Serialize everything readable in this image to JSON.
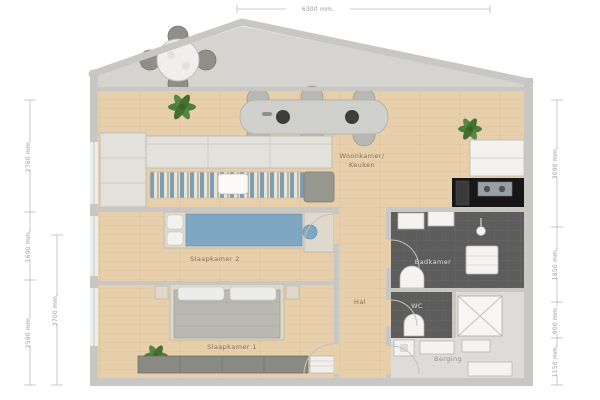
{
  "plan": {
    "type": "apartment-floor-plan",
    "rooms": {
      "living_line1": "Woonkamer/",
      "living_line2": "Keuken",
      "bedroom2": "Slaapkamer 2",
      "bedroom1": "Slaapkamer 1",
      "hall": "Hal",
      "bathroom": "Badkamer",
      "wc": "WC",
      "storage": "Berging"
    },
    "dimensions": {
      "top": "6300 mm.",
      "left_outer": [
        "2760 mm.",
        "1690 mm.",
        "2590 mm."
      ],
      "left_inner": "3700 mm.",
      "right": [
        "3090 mm.",
        "1850 mm.",
        "900 mm.",
        "1150 mm."
      ]
    },
    "colors": {
      "wood_floor": "#e7cfac",
      "terrace_floor": "#d6d4d0",
      "wall": "#c9c7c4",
      "tile_dark": "#5d5d5d",
      "bed_blue": "#7fa7c2",
      "rug_blue": "#7d9db5",
      "plant_green": "#4e7d3a",
      "wardrobe": "#8a8a84",
      "background": "#ffffff"
    }
  }
}
